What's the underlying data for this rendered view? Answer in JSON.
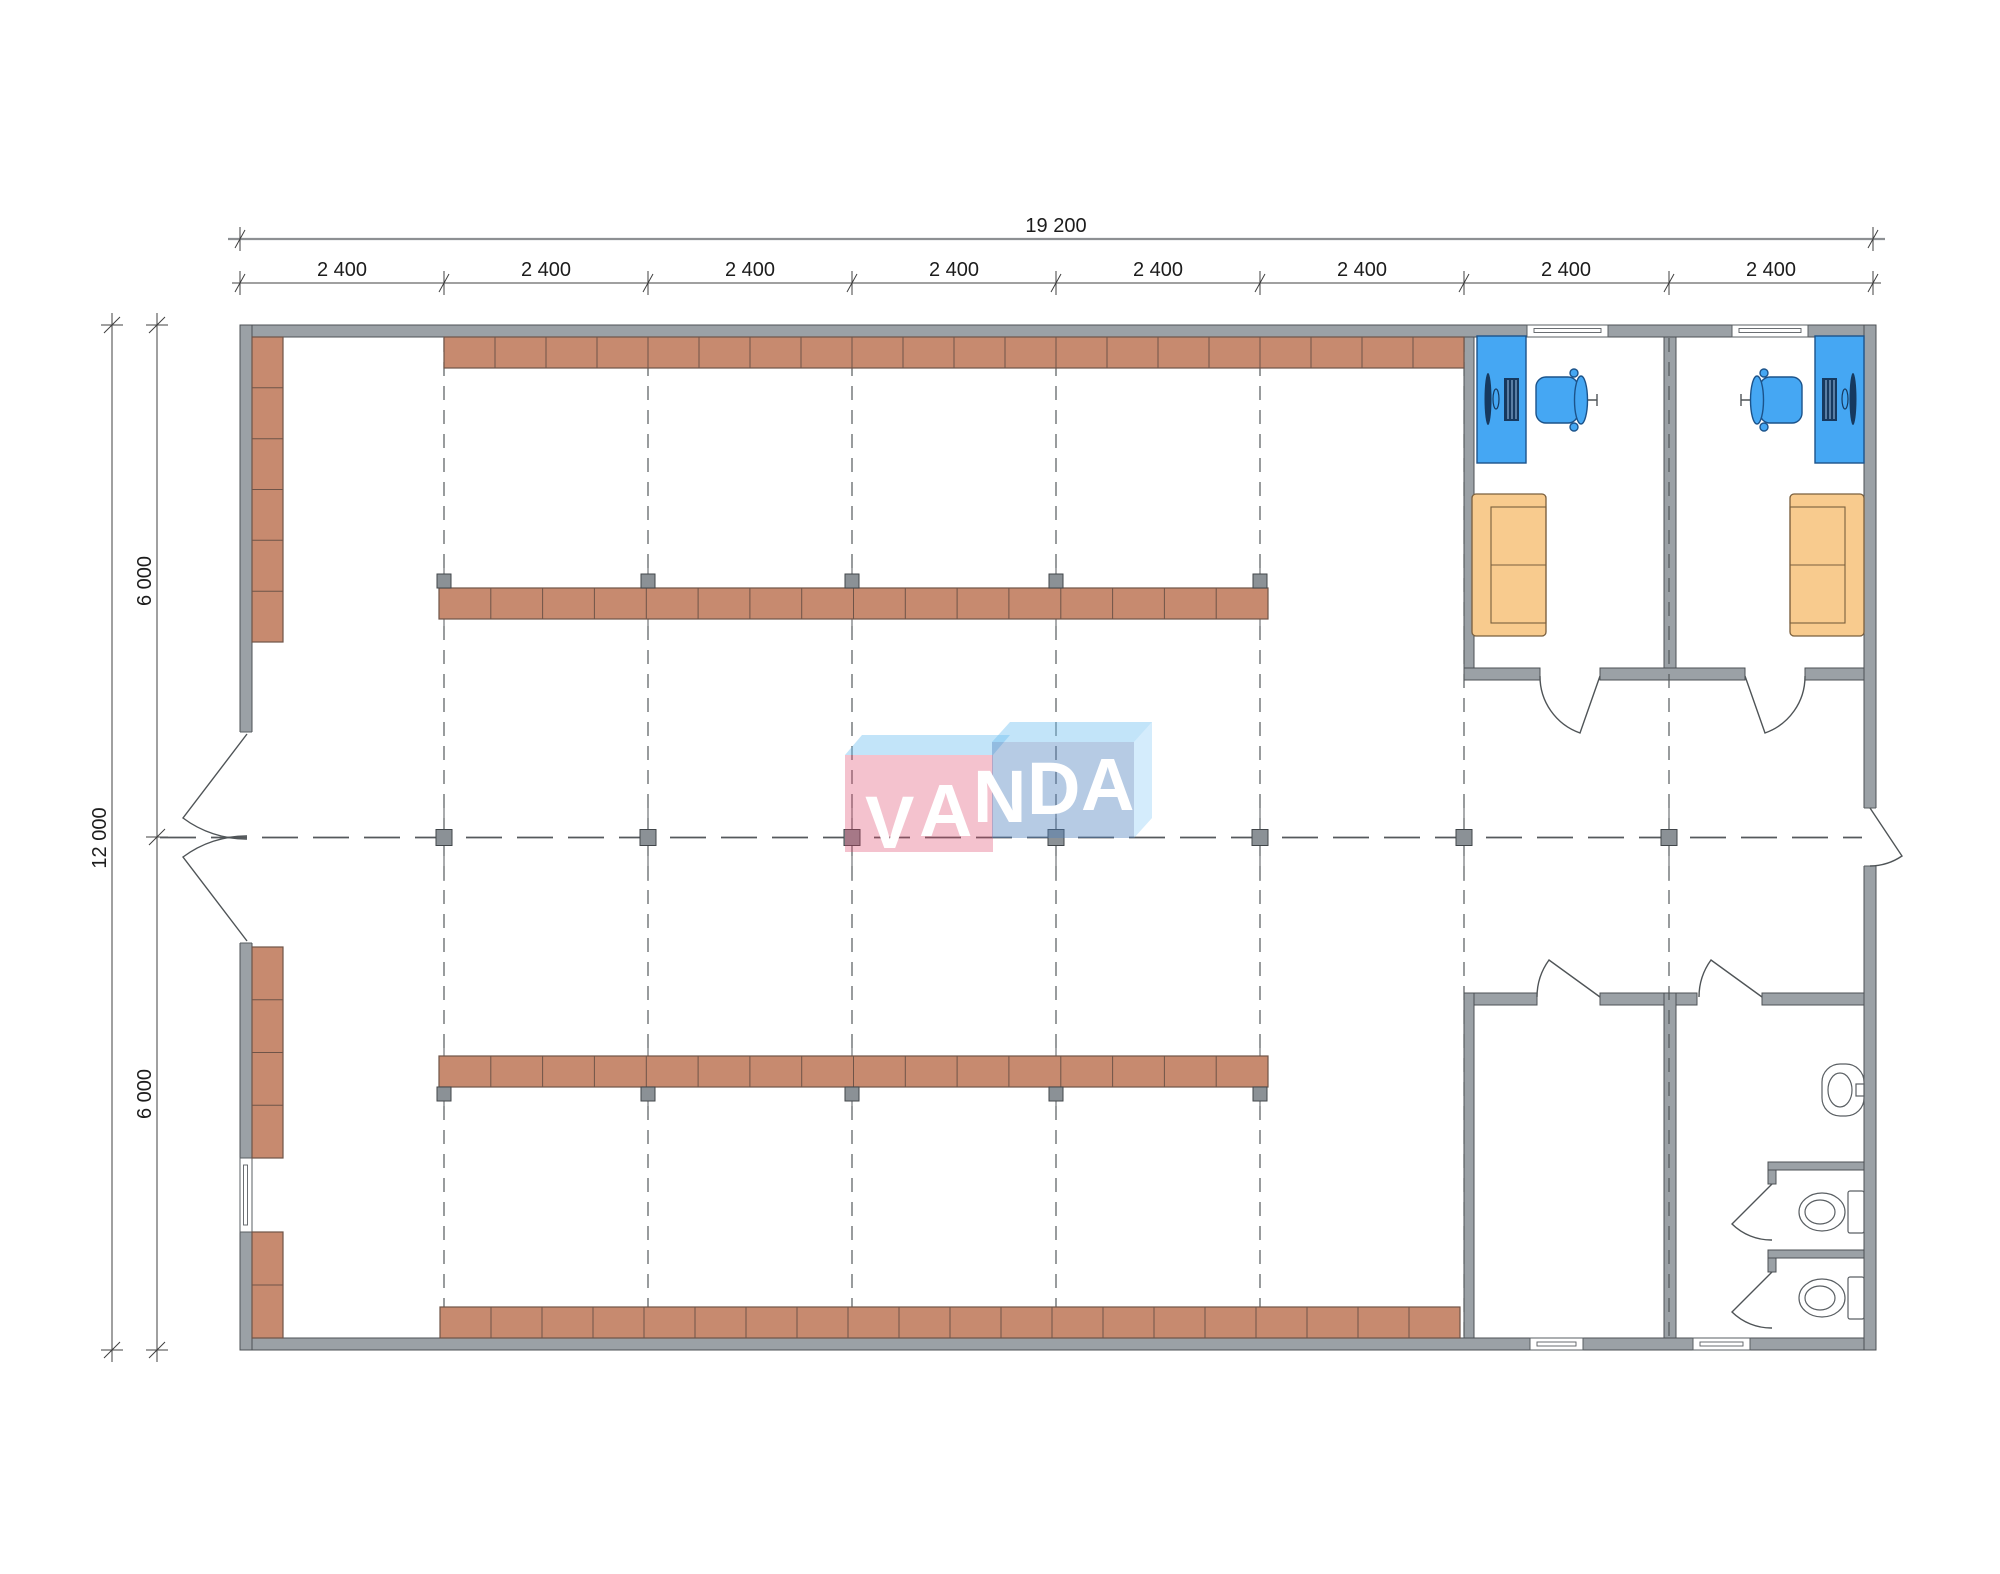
{
  "drawing": {
    "logo_text": "VANDA",
    "dim_total_width": "19 200",
    "dim_total_height": "12 000",
    "bay_labels": [
      "2 400",
      "2 400",
      "2 400",
      "2 400",
      "2 400",
      "2 400",
      "2 400",
      "2 400"
    ],
    "side_labels": [
      "6 000",
      "6 000"
    ]
  },
  "colors": {
    "wall_fill": "#9ba1a6",
    "wall_stroke": "#4c5155",
    "shelf_fill": "#c78a6f",
    "shelf_stroke": "#6f5448",
    "column_fill": "#8b9196",
    "column_stroke": "#41464a",
    "grid_line": "#55595c",
    "dim_line": "#404040",
    "dim_text": "#1c1c1c",
    "desk_fill": "#45a7f3",
    "desk_stroke": "#1c538a",
    "device_fill": "#16395f",
    "sofa_fill": "#f8cb8e",
    "sofa_stroke": "#7a5f3d",
    "fixture_stroke": "#5a5f63",
    "door_line": "#4f5457",
    "logo_pink": "rgba(222,70,105,0.33)",
    "logo_blue_front": "rgba(80,130,190,0.42)",
    "logo_top": "rgba(110,190,240,0.42)",
    "logo_side": "rgba(130,200,245,0.34)",
    "logo_text_color": "#ffffff"
  }
}
